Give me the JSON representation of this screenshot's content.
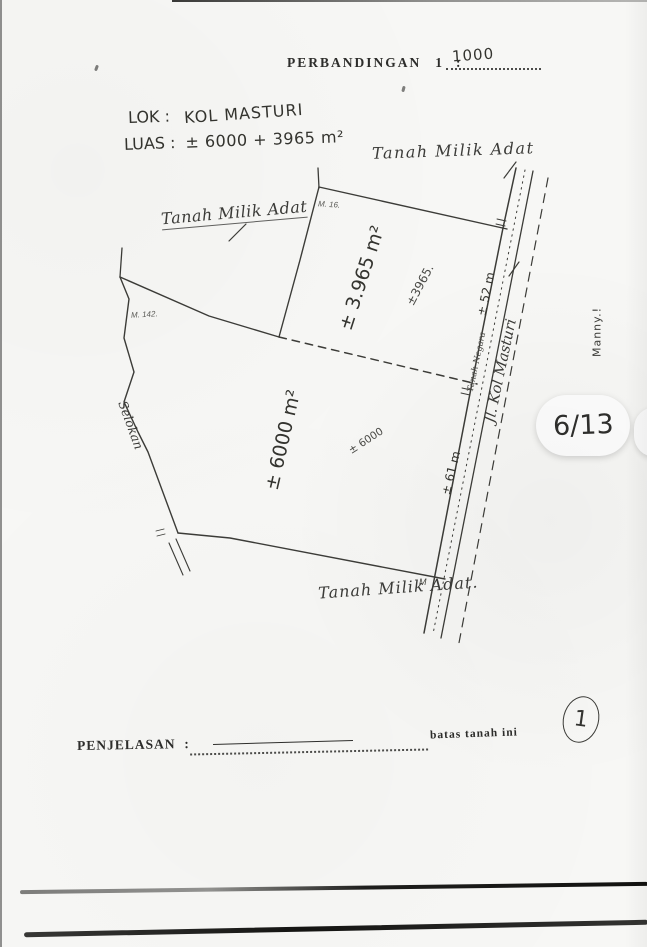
{
  "scale": {
    "label": "PERBANDINGAN",
    "ratio": "1",
    "colon": ":",
    "value": "1000"
  },
  "info": {
    "lok_label": "LOK :",
    "lok_value": "KOL MASTURI",
    "luas_label": "LUAS :",
    "luas_value": "± 6000 + 3965 m²"
  },
  "map": {
    "adat_top": "Tanah Milik Adat",
    "adat_left": "Tanah Milik Adat",
    "adat_bottom": "Tanah Milik Adat.",
    "area_upper": "± 3.965 m²",
    "area_upper_note": "±3965.",
    "area_lower": "± 6000 m²",
    "area_lower_note": "± 6000",
    "frontage_upper": "± 52 m",
    "frontage_lower": "± 61 m",
    "road_name": "Jl. Kol Masturi",
    "road_strip": "Tanah Negara",
    "ditch": "Selokan",
    "note_upper": "M. 16.",
    "note_left": "M. 142.",
    "corner_mark": "M"
  },
  "legend": {
    "label": "PENJELASAN",
    "colon": ":",
    "entry": "batas tanah ini"
  },
  "annotations": {
    "page_badge": "6/13",
    "circled_number": "1",
    "margin_note": "Manny.!"
  },
  "colors": {
    "ink": "#3a3a38",
    "paper": "#f7f7f5",
    "scan_bar": "#141412"
  }
}
